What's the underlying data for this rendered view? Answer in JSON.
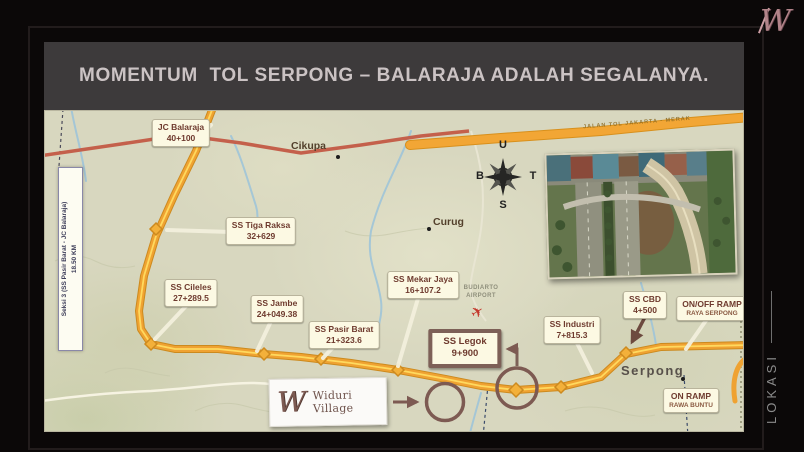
{
  "header": {
    "title": "MOMENTUM  TOL SERPONG – BALARAJA ADALAH SEGALANYA."
  },
  "brand": {
    "monogram": "W"
  },
  "side": {
    "label": "LOKASI"
  },
  "map": {
    "section_banner": {
      "line1": "Seksi 3 (SS Pasir Barat - JC Balaraja)",
      "line2": "18.50 KM"
    },
    "highway_label": "JALAN TOL JAKARTA - MERAK",
    "compass": {
      "north": "U",
      "west": "B",
      "east": "T",
      "south": "S"
    },
    "airport": {
      "line1": "BUDIARTO",
      "line2": "AIRPORT"
    },
    "towns": {
      "cikupa": "Cikupa",
      "curug": "Curug",
      "serpong": "Serpong"
    },
    "callouts": {
      "jc_balaraja": {
        "name": "JC Balaraja",
        "km": "40+100"
      },
      "tiga_raksa": {
        "name": "SS Tiga Raksa",
        "km": "32+629"
      },
      "cileles": {
        "name": "SS Cileles",
        "km": "27+289.5"
      },
      "jambe": {
        "name": "SS Jambe",
        "km": "24+049.38"
      },
      "pasir_barat": {
        "name": "SS Pasir Barat",
        "km": "21+323.6"
      },
      "mekar_jaya": {
        "name": "SS Mekar Jaya",
        "km": "16+107.2"
      },
      "legok": {
        "name": "SS Legok",
        "km": "9+900"
      },
      "industri": {
        "name": "SS Industri",
        "km": "7+815.3"
      },
      "cbd": {
        "name": "SS CBD",
        "km": "4+500"
      },
      "onoff_ramp": {
        "name": "ON/OFF RAMP",
        "km": "RAYA SERPONG"
      },
      "on_ramp": {
        "name": "ON RAMP",
        "km": "RAWA BUNTU"
      }
    },
    "marker_card": {
      "monogram": "W",
      "label": "Widuri Village"
    }
  },
  "colors": {
    "header_bg": "#3d3a3b",
    "map_bg": "#d8d7bf",
    "toll_orange": "#efa232",
    "toll_center": "#ffd95e",
    "arterial_red": "#c4604b",
    "marker_brown": "#7d5a52",
    "brand_rose": "#b2848a",
    "callout_text": "#6e3a2e"
  }
}
